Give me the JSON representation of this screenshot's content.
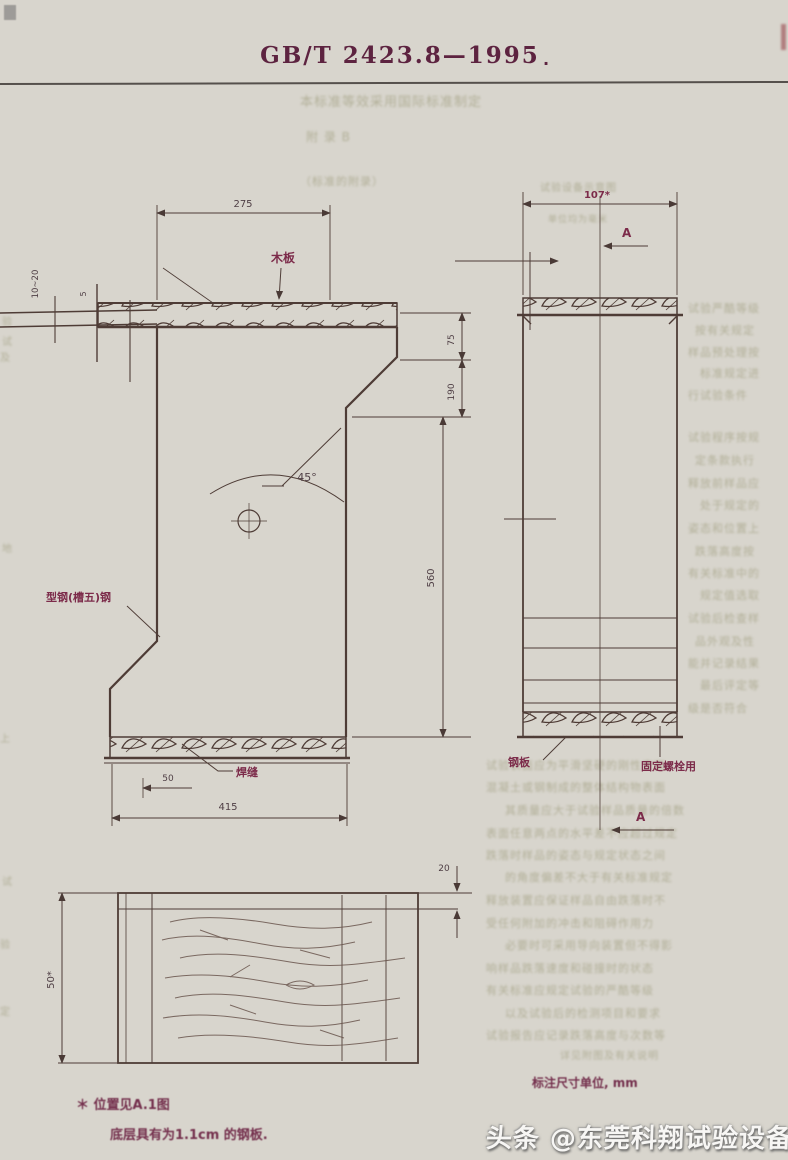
{
  "page": {
    "title_code": "GB/T 2423.8—1995",
    "title_dot": "."
  },
  "front_view": {
    "dim_top": "275",
    "label_board": "木板",
    "angle": "45°",
    "label_steel": "型钢(槽五)钢",
    "label_weld": "焊缝",
    "dim_50": "50",
    "dim_415": "415",
    "dim_75": "75",
    "dim_190": "190",
    "dim_560": "560",
    "dim_thickness_range": "10~20",
    "dim_small": "5"
  },
  "side_view": {
    "dim_top": "107*",
    "section_top": "A",
    "section_bottom": "A",
    "label_plate": "钢板",
    "label_bolt": "固定螺栓用"
  },
  "plan_view": {
    "dim_thickness": "20",
    "dim_height": "50*"
  },
  "notes": {
    "note1": "＊ 位置见A.1图",
    "note2": "底层具有为1.1cm 的钢板.",
    "units": "标注尺寸单位, mm"
  },
  "watermark": {
    "text": "头条 @东莞科翔试验设备"
  },
  "colors": {
    "line": "#4e3c36",
    "label_red": "#7c2b4a",
    "header": "#5d2340"
  },
  "ghost": {
    "top": [
      {
        "x": 300,
        "y": 96,
        "fs": 13,
        "t": "本标准等效采用国际标准制定"
      },
      {
        "x": 306,
        "y": 131,
        "fs": 12,
        "t": "附  录  B"
      },
      {
        "x": 300,
        "y": 176,
        "fs": 11,
        "t": "（标准的附录）"
      },
      {
        "x": 540,
        "y": 184,
        "fs": 10,
        "t": "试验设备示意图"
      },
      {
        "x": 548,
        "y": 216,
        "fs": 9,
        "t": "单位均为毫米"
      }
    ],
    "lines": [
      {
        "x": 688,
        "y": 303,
        "fs": 11,
        "t": "试验严酷等级"
      },
      {
        "x": 695,
        "y": 325,
        "fs": 11,
        "t": "按有关规定"
      },
      {
        "x": 688,
        "y": 347,
        "fs": 11,
        "t": "样品预处理按"
      },
      {
        "x": 700,
        "y": 368,
        "fs": 11,
        "t": "标准规定进"
      },
      {
        "x": 688,
        "y": 390,
        "fs": 11,
        "t": "行试验条件"
      },
      {
        "x": 688,
        "y": 432,
        "fs": 11,
        "t": "试验程序按规"
      },
      {
        "x": 695,
        "y": 455,
        "fs": 11,
        "t": "定条款执行"
      },
      {
        "x": 688,
        "y": 478,
        "fs": 11,
        "t": "释放前样品应"
      },
      {
        "x": 700,
        "y": 500,
        "fs": 11,
        "t": "处于规定的"
      },
      {
        "x": 688,
        "y": 523,
        "fs": 11,
        "t": "姿态和位置上"
      },
      {
        "x": 695,
        "y": 546,
        "fs": 11,
        "t": "跌落高度按"
      },
      {
        "x": 688,
        "y": 568,
        "fs": 11,
        "t": "有关标准中的"
      },
      {
        "x": 700,
        "y": 590,
        "fs": 11,
        "t": "规定值选取"
      },
      {
        "x": 688,
        "y": 613,
        "fs": 11,
        "t": "试验后检查样"
      },
      {
        "x": 695,
        "y": 636,
        "fs": 11,
        "t": "品外观及性"
      },
      {
        "x": 688,
        "y": 658,
        "fs": 11,
        "t": "能并记录结果"
      },
      {
        "x": 700,
        "y": 680,
        "fs": 11,
        "t": "最后评定等"
      },
      {
        "x": 688,
        "y": 703,
        "fs": 11,
        "t": "级是否符合"
      },
      {
        "x": 486,
        "y": 760,
        "fs": 11,
        "t": "试验表面应为平滑坚硬的刚性表面"
      },
      {
        "x": 486,
        "y": 782,
        "fs": 11,
        "t": "混凝土或钢制成的整体结构物表面"
      },
      {
        "x": 505,
        "y": 805,
        "fs": 11,
        "t": "其质量应大于试验样品质量的倍数"
      },
      {
        "x": 486,
        "y": 828,
        "fs": 11,
        "t": "表面任意两点的水平差不应超过规定"
      },
      {
        "x": 486,
        "y": 850,
        "fs": 11,
        "t": "跌落时样品的姿态与规定状态之间"
      },
      {
        "x": 505,
        "y": 872,
        "fs": 11,
        "t": "的角度偏差不大于有关标准规定"
      },
      {
        "x": 486,
        "y": 895,
        "fs": 11,
        "t": "释放装置应保证样品自由跌落时不"
      },
      {
        "x": 486,
        "y": 918,
        "fs": 11,
        "t": "受任何附加的冲击和阻碍作用力"
      },
      {
        "x": 505,
        "y": 940,
        "fs": 11,
        "t": "必要时可采用导向装置但不得影"
      },
      {
        "x": 486,
        "y": 963,
        "fs": 11,
        "t": "响样品跌落速度和碰撞时的状态"
      },
      {
        "x": 486,
        "y": 985,
        "fs": 11,
        "t": "有关标准应规定试验的严酷等级"
      },
      {
        "x": 505,
        "y": 1008,
        "fs": 11,
        "t": "以及试验后的检测项目和要求"
      },
      {
        "x": 486,
        "y": 1030,
        "fs": 11,
        "t": "试验报告应记录跌落高度与次数等"
      },
      {
        "x": 560,
        "y": 1052,
        "fs": 10,
        "t": "详见附图及有关说明"
      },
      {
        "x": 2,
        "y": 318,
        "fs": 10,
        "t": "验"
      },
      {
        "x": 2,
        "y": 338,
        "fs": 10,
        "t": "试"
      },
      {
        "x": 0,
        "y": 354,
        "fs": 10,
        "t": "及"
      },
      {
        "x": 2,
        "y": 545,
        "fs": 10,
        "t": "地"
      },
      {
        "x": 0,
        "y": 735,
        "fs": 10,
        "t": "上"
      },
      {
        "x": 2,
        "y": 878,
        "fs": 10,
        "t": "试"
      },
      {
        "x": 0,
        "y": 941,
        "fs": 10,
        "t": "验"
      },
      {
        "x": 0,
        "y": 1008,
        "fs": 10,
        "t": "定"
      }
    ]
  }
}
